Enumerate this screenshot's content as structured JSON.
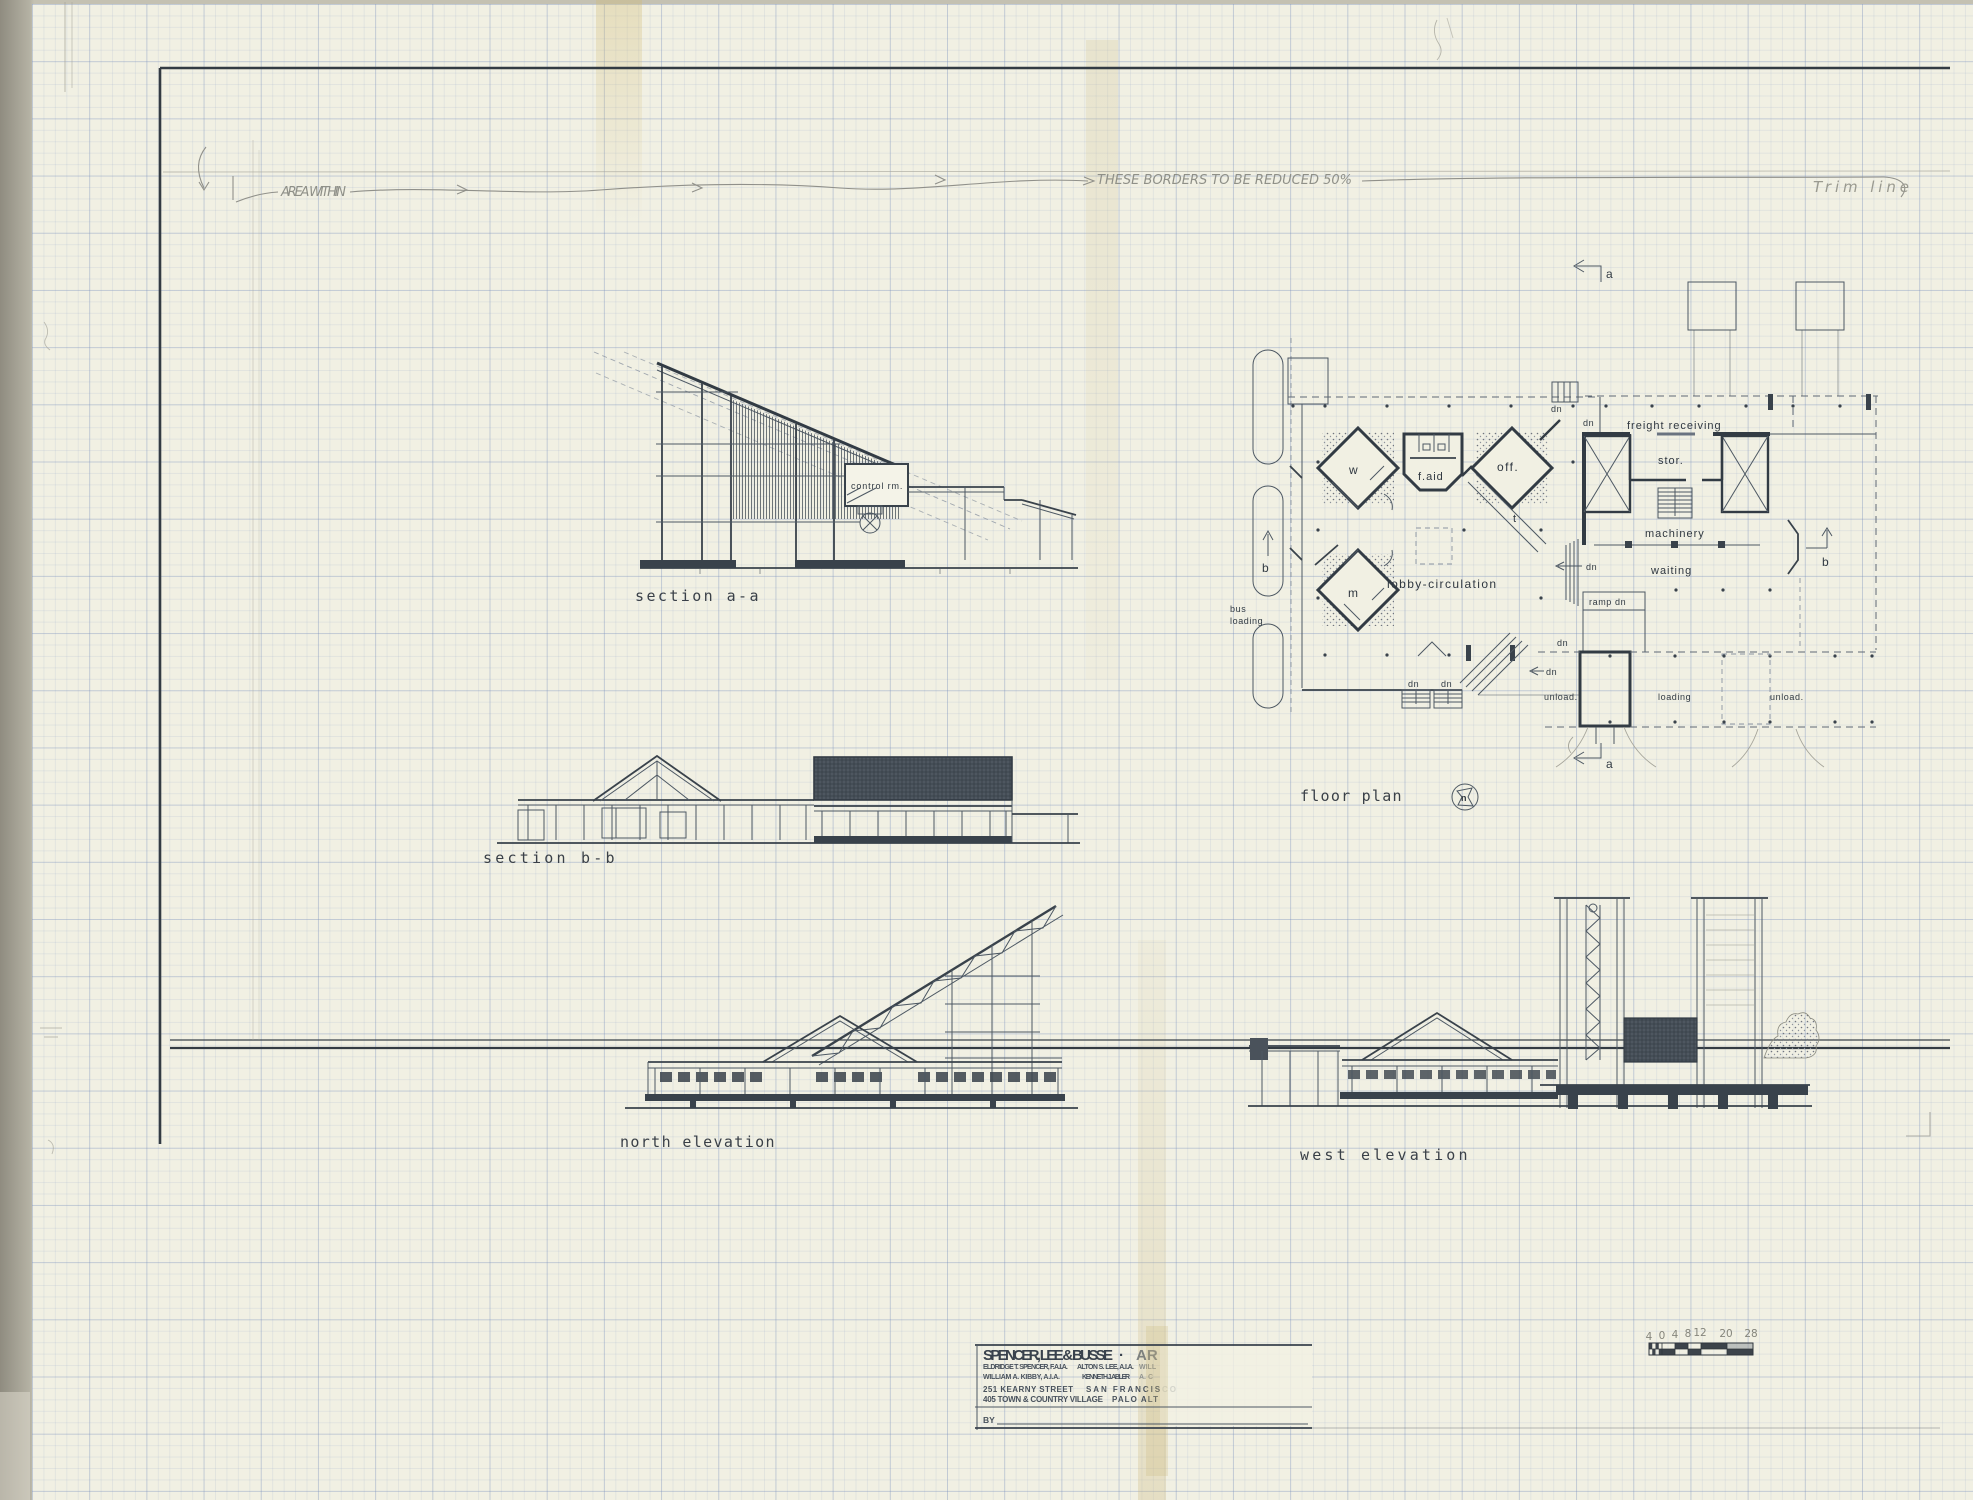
{
  "sheet": {
    "annotations": {
      "area_within": "AREA WITHIN",
      "borders_note": "THESE BORDERS TO BE REDUCED 50%",
      "trim_line": "Trim line"
    }
  },
  "drawings": {
    "section_aa": {
      "caption": "section a-a",
      "control_room": "control rm."
    },
    "section_bb": {
      "caption": "section b-b"
    },
    "north_elevation": {
      "caption": "north elevation"
    },
    "west_elevation": {
      "caption": "west elevation"
    },
    "floor_plan": {
      "caption": "floor plan",
      "north_marker": "n",
      "marker_a": "a",
      "marker_b": "b",
      "rooms": {
        "freight_receiving": "freight receiving",
        "storage": "stor.",
        "machinery": "machinery",
        "waiting": "waiting",
        "first_aid": "f.aid",
        "office": "off.",
        "women": "w",
        "men": "m",
        "tickets": "t",
        "lobby": "lobby-circulation"
      },
      "labels": {
        "bus": "bus",
        "bus_loading": "loading",
        "ramp_dn": "ramp dn",
        "dn": "dn",
        "unload": "unload.",
        "loading": "loading"
      }
    }
  },
  "title_block": {
    "firm": "SPENCER, LEE & BUSSE",
    "separator": "·",
    "firm_cut": "AR",
    "partner_1": "ELDRIDGE T. SPENCER, F.A.I.A.",
    "partner_2": "ALTON S. LEE, A.I.A.",
    "partner_3_cut": "WILL",
    "associate_1": "WILLIAM A. KIBBY, A.I.A.",
    "associate_2": "KENNETH J. ABLER",
    "associate_3_cut": "A. C",
    "address_1": "251 KEARNY STREET",
    "address_1_city": "SAN FRANCISCO",
    "address_2": "405 TOWN & COUNTRY VILLAGE",
    "address_2_city": "PALO ALT",
    "by_label": "BY"
  },
  "scale_bar": {
    "ticks": [
      "4",
      "0",
      "4",
      "8",
      "12",
      "20",
      "28"
    ]
  }
}
